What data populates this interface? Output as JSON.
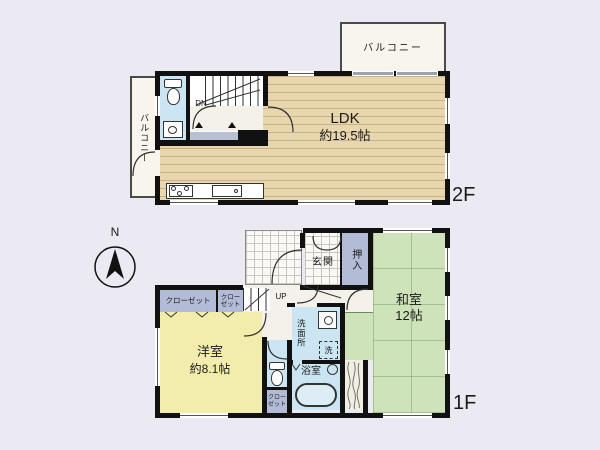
{
  "floor2": {
    "label": "2F",
    "balcony_top": "バルコニー",
    "balcony_left": "バルコニー",
    "ldk": {
      "name": "LDK",
      "size": "約19.5帖"
    },
    "stairs_label": "DN"
  },
  "floor1": {
    "label": "1F",
    "compass": "N",
    "entrance": "玄関",
    "oshiire": "押入",
    "japanese_room": {
      "name": "和室",
      "size": "12帖"
    },
    "western_room": {
      "name": "洋室",
      "size": "約8.1帖"
    },
    "closet_west_large": "クローゼット",
    "closet_west_small": "クローゼット",
    "closet_south": "クローゼット",
    "stairs_label": "UP",
    "washroom": "洗面所",
    "washing_machine": "洗",
    "bathroom": "浴室"
  },
  "colors": {
    "background": "#ebeaf2",
    "wall": "#111111",
    "ldk_floor": "#e8d6ae",
    "tatami": "#cfe3ba",
    "western_floor": "#f3edad",
    "wet_area": "#cbe6f2",
    "closet": "#b2bcd6",
    "balcony": "#f8f5ec",
    "hall": "#f4f1ea"
  }
}
